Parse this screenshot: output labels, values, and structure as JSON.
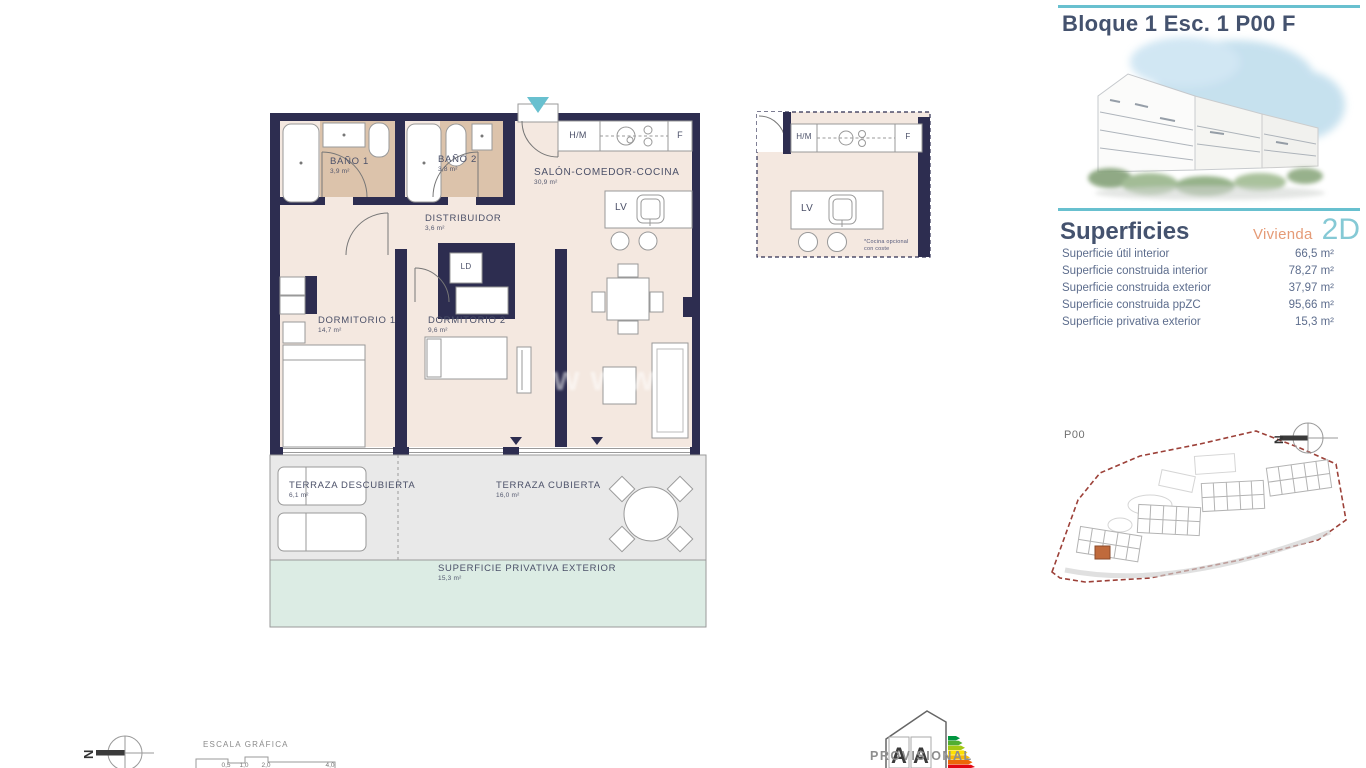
{
  "colors": {
    "wall": "#2d2d50",
    "floor": "#f4e8e0",
    "bath_floor": "#dcc3ab",
    "teal_accent": "#68c0cf",
    "slate_title": "#44526e",
    "orange_accent": "#e59b77",
    "code_teal": "#85c9d5",
    "terrace_gray": "#e9e9e9",
    "exterior_mint": "#dcece4",
    "site_boundary_red": "#9c4038",
    "highlight_unit_orange": "#c06a3c",
    "energy_scale": [
      "#009640",
      "#52ae32",
      "#a5c814",
      "#ffe000",
      "#fbba00",
      "#ec6608",
      "#e30613"
    ]
  },
  "plan": {
    "watermark": "www",
    "rooms": {
      "bano1": {
        "label": "BAÑO 1",
        "area": "3,9 m²"
      },
      "bano2": {
        "label": "BAÑO 2",
        "area": "3,8 m²"
      },
      "salon": {
        "label": "SALÓN-COMEDOR-COCINA",
        "area": "30,9 m²"
      },
      "distribuidor": {
        "label": "DISTRIBUIDOR",
        "area": "3,6 m²"
      },
      "dorm1": {
        "label": "DORMITORIO 1",
        "area": "14,7 m²"
      },
      "dorm2": {
        "label": "DORMITORIO 2",
        "area": "9,6 m²"
      },
      "terraza_descubierta": {
        "label": "TERRAZA DESCUBIERTA",
        "area": "6,1 m²"
      },
      "terraza_cubierta": {
        "label": "TERRAZA CUBIERTA",
        "area": "16,0 m²"
      },
      "superficie_privativa": {
        "label": "SUPERFICIE PRIVATIVA EXTERIOR",
        "area": "15,3 m²"
      }
    },
    "fixtures": {
      "hm": "H/M",
      "f": "F",
      "lv": "LV",
      "ld": "LD"
    },
    "detail": {
      "hm": "H/M",
      "f": "F",
      "lv": "LV",
      "note_line1": "*Cocina opcional",
      "note_line2": "con coste"
    }
  },
  "sidebar": {
    "title": "Bloque 1 Esc. 1 P00 F",
    "section_title": "Superficies",
    "vivienda_label": "Vivienda",
    "vivienda_code": "2D",
    "rows": [
      {
        "label": "Superficie útil interior",
        "value": "66,5 m²"
      },
      {
        "label": "Superficie construida interior",
        "value": "78,27 m²"
      },
      {
        "label": "Superficie construida exterior",
        "value": "37,97 m²"
      },
      {
        "label": "Superficie construida ppZC",
        "value": "95,66 m²"
      },
      {
        "label": "Superficie privativa exterior",
        "value": "15,3 m²"
      }
    ],
    "siteplan": {
      "floor_label": "P00",
      "north_letter": "N"
    }
  },
  "footer": {
    "north_letter": "N",
    "escala_label": "ESCALA GRÁFICA",
    "scale_ticks": [
      "0,5",
      "1,0",
      "2,0",
      "4,0"
    ],
    "provisional_label": "PROVISIONAL",
    "energy_letter_consumo": "A",
    "energy_letter_emisiones": "A"
  }
}
